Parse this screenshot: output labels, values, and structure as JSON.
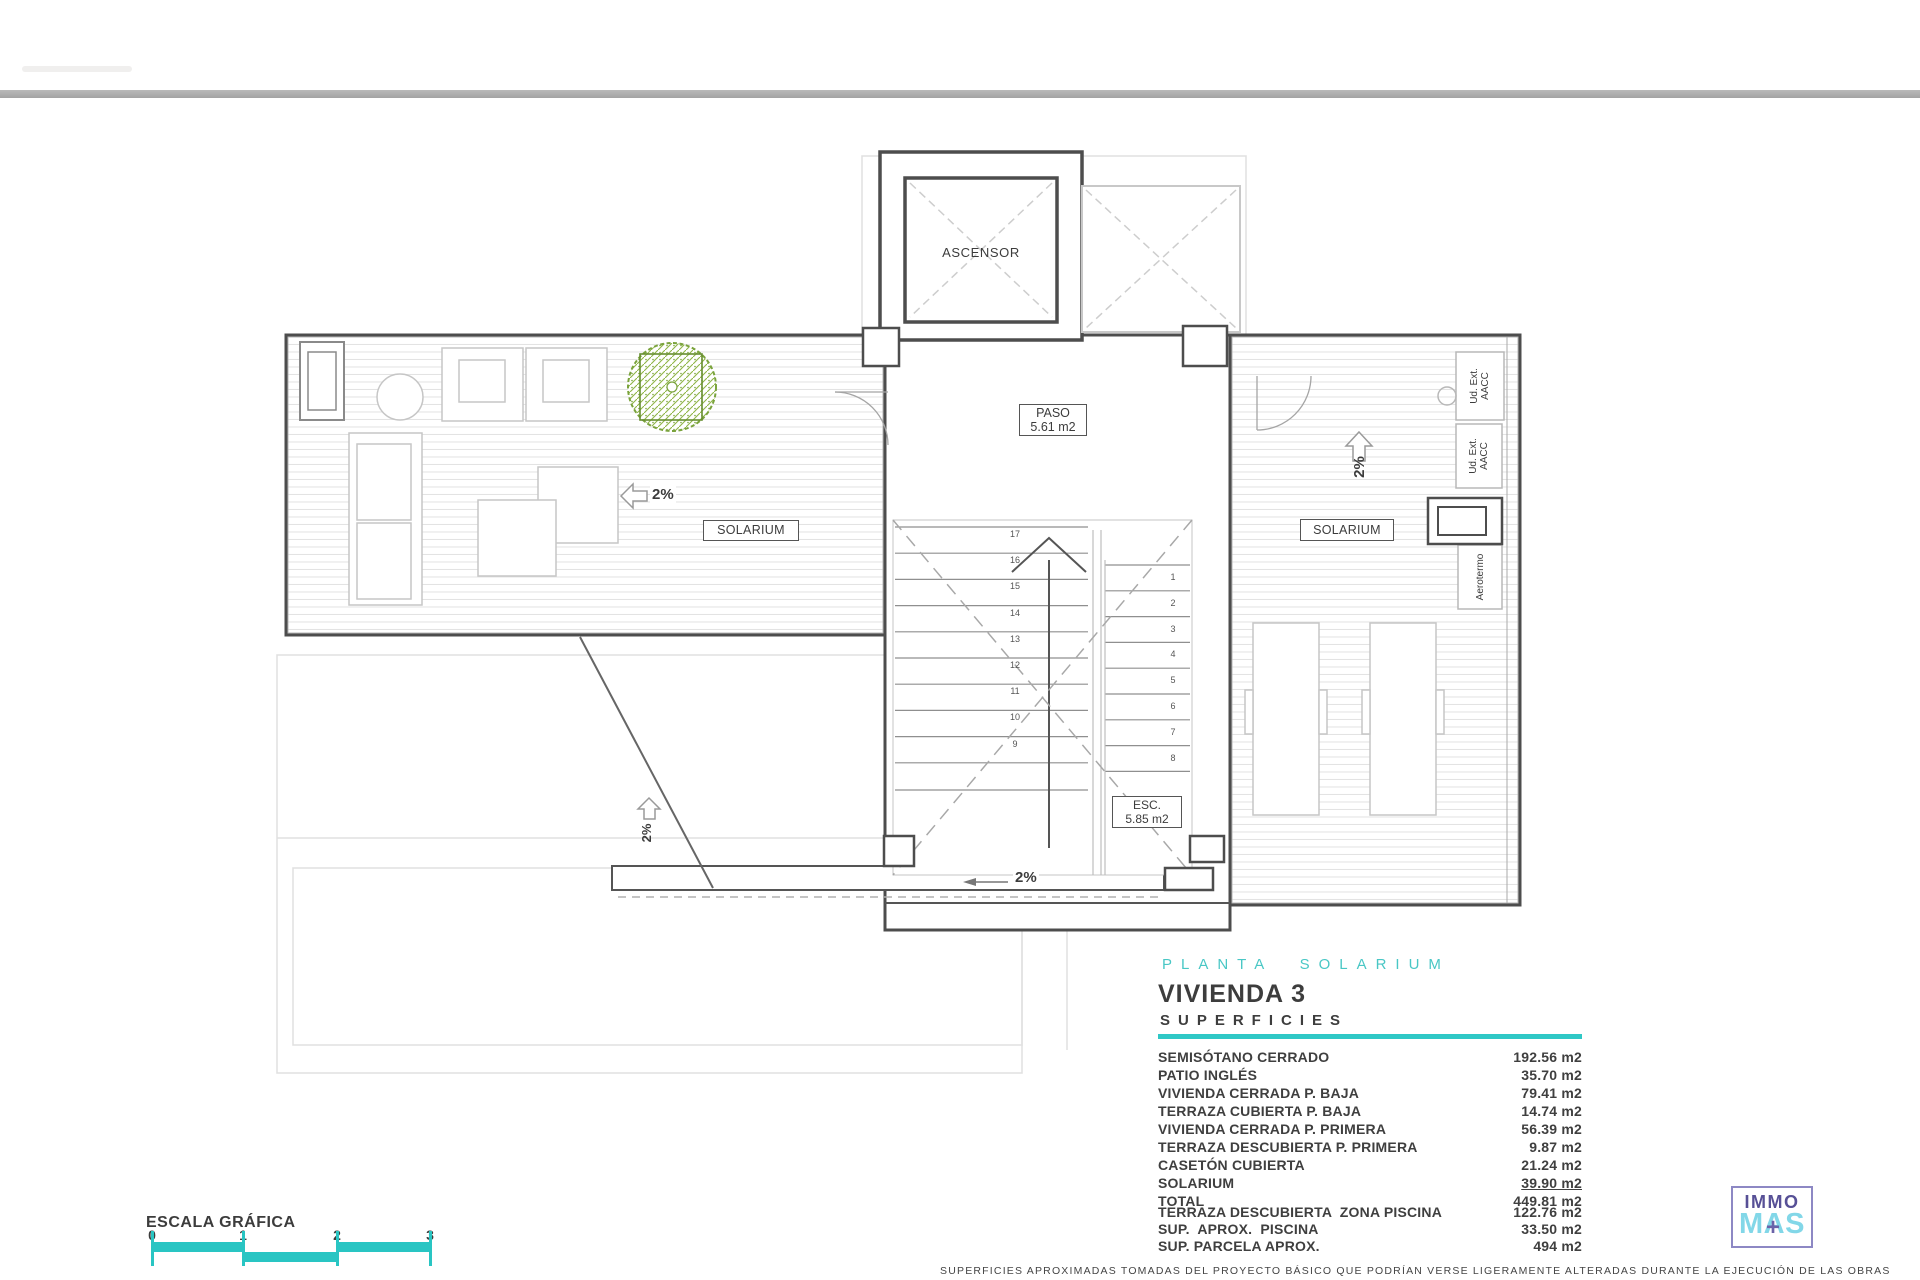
{
  "drawing": {
    "labels": {
      "ascensor": "ASCENSOR",
      "paso_name": "PASO",
      "paso_area": "5.61 m2",
      "esc_name": "ESC.",
      "esc_area": "5.85 m2",
      "solarium_left": "SOLARIUM",
      "solarium_right": "SOLARIUM",
      "slope_left": "2%",
      "slope_right": "2%",
      "slope_strip": "2%",
      "slope_corridor": "2%",
      "ud_ext_line1": "Ud. Ext.",
      "ud_ext_line2": "AACC",
      "aerotermo": "Aerotermo"
    },
    "stair_numbers_left": [
      "17",
      "16",
      "15",
      "14",
      "13",
      "12",
      "11",
      "10",
      "9"
    ],
    "stair_numbers_right": [
      "1",
      "2",
      "3",
      "4",
      "5",
      "6",
      "7",
      "8"
    ],
    "line_color": "#4d4d4d",
    "furniture_color": "#c6c6c6",
    "tree_color": "#7aa33c"
  },
  "title_block": {
    "plan_name": "PLANTA SOLARIUM",
    "unit_name": "VIVIENDA 3",
    "section_title": "SUPERFICIES",
    "accent_color": "#2fc8c6",
    "surfaces": [
      {
        "label": "SEMISÓTANO CERRADO",
        "value": "192.56 m2"
      },
      {
        "label": "PATIO INGLÉS",
        "value": "35.70 m2"
      },
      {
        "label": "VIVIENDA CERRADA P. BAJA",
        "value": "79.41 m2"
      },
      {
        "label": "TERRAZA CUBIERTA P. BAJA",
        "value": "14.74 m2"
      },
      {
        "label": "VIVIENDA CERRADA P. PRIMERA",
        "value": "56.39 m2"
      },
      {
        "label": "TERRAZA DESCUBIERTA P. PRIMERA",
        "value": "9.87 m2"
      },
      {
        "label": "CASETÓN CUBIERTA",
        "value": "21.24 m2"
      },
      {
        "label": "SOLARIUM",
        "value": "39.90 m2",
        "underline": true
      },
      {
        "label": "TOTAL",
        "value": "449.81 m2"
      }
    ],
    "extra_surfaces": [
      {
        "label": "TERRAZA DESCUBIERTA  ZONA PISCINA",
        "value": "122.76 m2"
      },
      {
        "label": "SUP.  APROX.  PISCINA",
        "value": "33.50 m2"
      },
      {
        "label": "SUP. PARCELA APROX.",
        "value": "494 m2"
      }
    ]
  },
  "footer": {
    "disclaimer": "SUPERFICIES APROXIMADAS TOMADAS DEL PROYECTO BÁSICO QUE PODRÍAN VERSE LIGERAMENTE ALTERADAS DURANTE LA EJECUCIÓN DE LAS OBRAS"
  },
  "scale_bar": {
    "title": "ESCALA GRÁFICA",
    "ticks": [
      "0",
      "1",
      "2",
      "3"
    ],
    "color": "#29c5c3"
  },
  "logo": {
    "line1": "IMMO",
    "line2": "MAS",
    "plus": "+",
    "line1_color": "#575096",
    "line2_color": "#82d7e8",
    "border_color": "#8d88c4"
  }
}
